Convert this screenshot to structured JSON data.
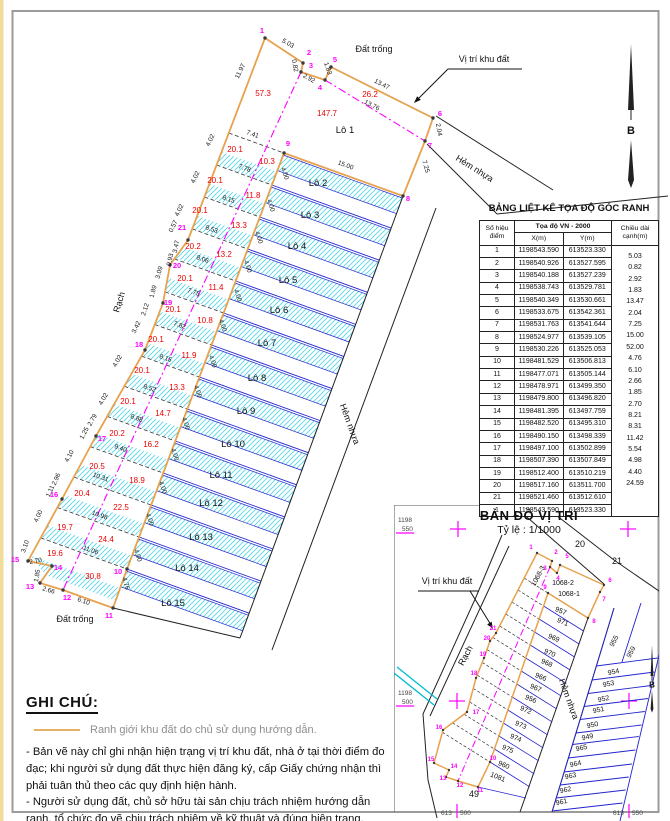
{
  "colors": {
    "orange": "#e8a14d",
    "magenta": "#ff00ff",
    "red": "#ee0000",
    "blue": "#2323cf",
    "hatch": "#56d7e9",
    "cyan": "#00bcd0",
    "black": "#1a1a1a"
  },
  "table": {
    "title": "BẢNG LIỆT KÊ TỌA ĐỘ GÓC RANH",
    "col_point_1": "Số hiệu",
    "col_point_2": "điểm",
    "col_coord": "Tọa độ VN - 2000",
    "col_x": "X(m)",
    "col_y": "Y(m)",
    "col_len_1": "Chiều dài",
    "col_len_2": "cạnh(m)",
    "rows": [
      [
        "1",
        "1198543.590",
        "613523.330"
      ],
      [
        "2",
        "1198540.926",
        "613527.595"
      ],
      [
        "3",
        "1198540.188",
        "613527.239"
      ],
      [
        "4",
        "1198538.743",
        "613529.781"
      ],
      [
        "5",
        "1198540.349",
        "613530.661"
      ],
      [
        "6",
        "1198533.675",
        "613542.361"
      ],
      [
        "7",
        "1198531.763",
        "613541.644"
      ],
      [
        "8",
        "1198524.977",
        "613539.105"
      ],
      [
        "9",
        "1198530.226",
        "613525.053"
      ],
      [
        "10",
        "1198481.529",
        "613506.813"
      ],
      [
        "11",
        "1198477.071",
        "613505.144"
      ],
      [
        "12",
        "1198478.971",
        "613499.350"
      ],
      [
        "13",
        "1198479.800",
        "613496.820"
      ],
      [
        "14",
        "1198481.395",
        "613497.759"
      ],
      [
        "15",
        "1198482.520",
        "613495.310"
      ],
      [
        "16",
        "1198490.150",
        "613498.339"
      ],
      [
        "17",
        "1198497.100",
        "613502.899"
      ],
      [
        "18",
        "1198507.390",
        "613507.849"
      ],
      [
        "19",
        "1198512.400",
        "613510.219"
      ],
      [
        "20",
        "1198517.160",
        "613511.700"
      ],
      [
        "21",
        "1198521.460",
        "613512.610"
      ],
      [
        "1",
        "1198543.590",
        "613523.330"
      ]
    ],
    "lengths": [
      "5.03",
      "0.82",
      "2.92",
      "1.83",
      "13.47",
      "2.04",
      "7.25",
      "15.00",
      "52.00",
      "4.76",
      "6.10",
      "2.66",
      "1.85",
      "2.70",
      "8.21",
      "8.31",
      "11.42",
      "5.54",
      "4.98",
      "4.40",
      "24.59"
    ]
  },
  "drawing": {
    "north_label": "B",
    "dims": [
      [
        287,
        45,
        "5.03",
        30
      ],
      [
        293,
        66,
        "0.82",
        80
      ],
      [
        308,
        80,
        "2.92",
        30
      ],
      [
        326,
        69,
        "1.83",
        72
      ],
      [
        381,
        86,
        "13.47",
        27
      ],
      [
        437,
        130,
        "2.04",
        80
      ],
      [
        424,
        167,
        "7.25",
        74
      ],
      [
        345,
        167,
        "15.00",
        20
      ],
      [
        371,
        107,
        "13.76",
        27
      ],
      [
        242,
        72,
        "11.97",
        -64
      ],
      [
        212,
        141,
        "4.02",
        -64
      ],
      [
        197,
        178,
        "4.02",
        -64
      ],
      [
        181,
        211,
        "4.02",
        -64
      ],
      [
        175,
        227,
        "0.57",
        -64
      ],
      [
        178,
        247,
        "3.47",
        -78
      ],
      [
        172,
        260,
        "0.93",
        -78
      ],
      [
        161,
        273,
        "3.09",
        -75
      ],
      [
        155,
        292,
        "1.89",
        -75
      ],
      [
        147,
        310,
        "2.12",
        -72
      ],
      [
        138,
        328,
        "3.42",
        -64
      ],
      [
        119,
        362,
        "4.02",
        -60
      ],
      [
        105,
        400,
        "4.02",
        -60
      ],
      [
        94,
        421,
        "2.79",
        -60
      ],
      [
        86,
        434,
        "1.25",
        -62
      ],
      [
        71,
        457,
        "4.10",
        -62
      ],
      [
        58,
        480,
        "2.96",
        -66
      ],
      [
        52,
        492,
        "1.11",
        -66
      ],
      [
        40,
        517,
        "4.00",
        -66
      ],
      [
        27,
        547,
        "3.10",
        -72
      ],
      [
        36,
        563,
        "2.70",
        -10
      ],
      [
        39,
        576,
        "1.85",
        -80
      ],
      [
        48,
        592,
        "2.66",
        17
      ],
      [
        83,
        603,
        "6.10",
        18
      ],
      [
        124,
        584,
        "4.76",
        74
      ],
      [
        252,
        136,
        "7.41",
        20
      ],
      [
        244,
        170,
        "7.78",
        20
      ],
      [
        228,
        201,
        "8.15",
        20
      ],
      [
        211,
        231,
        "8.53",
        20
      ],
      [
        202,
        261,
        "8.06",
        20
      ],
      [
        193,
        294,
        "7.75",
        20
      ],
      [
        179,
        327,
        "7.82",
        20
      ],
      [
        165,
        360,
        "8.15",
        20
      ],
      [
        149,
        390,
        "8.52",
        20
      ],
      [
        136,
        420,
        "8.88",
        20
      ],
      [
        120,
        450,
        "9.40",
        20
      ],
      [
        100,
        479,
        "10.31",
        20
      ],
      [
        99,
        517,
        "10.98",
        20
      ],
      [
        90,
        552,
        "11.06",
        20
      ],
      [
        283,
        174,
        "4.00",
        72
      ],
      [
        269,
        206,
        "4.00",
        72
      ],
      [
        257,
        238,
        "4.00",
        72
      ],
      [
        246,
        267,
        "4.00",
        72
      ],
      [
        236,
        296,
        "4.00",
        72
      ],
      [
        221,
        326,
        "4.00",
        72
      ],
      [
        211,
        362,
        "4.00",
        72
      ],
      [
        196,
        392,
        "4.00",
        72
      ],
      [
        184,
        424,
        "4.00",
        72
      ],
      [
        173,
        455,
        "4.00",
        72
      ],
      [
        161,
        488,
        "4.00",
        72
      ],
      [
        148,
        520,
        "4.00",
        72
      ],
      [
        136,
        556,
        "4.00",
        72
      ]
    ],
    "areas": [
      [
        263,
        96,
        "57.3"
      ],
      [
        327,
        116,
        "147.7"
      ],
      [
        370,
        97,
        "26.2"
      ],
      [
        235,
        152,
        "20.1"
      ],
      [
        215,
        183,
        "20.1"
      ],
      [
        200,
        213,
        "20.1"
      ],
      [
        193,
        249,
        "20.2"
      ],
      [
        185,
        281,
        "20.1"
      ],
      [
        173,
        312,
        "20.1"
      ],
      [
        156,
        342,
        "20.1"
      ],
      [
        142,
        373,
        "20.1"
      ],
      [
        128,
        404,
        "20.1"
      ],
      [
        117,
        436,
        "20.2"
      ],
      [
        97,
        469,
        "20.5"
      ],
      [
        82,
        496,
        "20.4"
      ],
      [
        65,
        530,
        "19.7"
      ],
      [
        55,
        556,
        "19.6"
      ],
      [
        267,
        164,
        "10.3"
      ],
      [
        253,
        198,
        "11.8"
      ],
      [
        239,
        228,
        "13.3"
      ],
      [
        224,
        257,
        "13.2"
      ],
      [
        216,
        290,
        "11.4"
      ],
      [
        205,
        323,
        "10.8"
      ],
      [
        189,
        358,
        "11.9"
      ],
      [
        177,
        390,
        "13.3"
      ],
      [
        163,
        416,
        "14.7"
      ],
      [
        151,
        447,
        "16.2"
      ],
      [
        137,
        483,
        "18.9"
      ],
      [
        121,
        510,
        "22.5"
      ],
      [
        106,
        542,
        "24.4"
      ],
      [
        93,
        579,
        "30.8"
      ]
    ],
    "points": [
      [
        262,
        33,
        "1"
      ],
      [
        309,
        55,
        "2"
      ],
      [
        311,
        68,
        "3"
      ],
      [
        320,
        90,
        "4"
      ],
      [
        335,
        62,
        "5"
      ],
      [
        440,
        116,
        "6"
      ],
      [
        430,
        148,
        "7"
      ],
      [
        408,
        201,
        "8"
      ],
      [
        288,
        146,
        "9"
      ],
      [
        118,
        574,
        "10"
      ],
      [
        109,
        618,
        "11"
      ],
      [
        67,
        600,
        "12"
      ],
      [
        30,
        589,
        "13"
      ],
      [
        58,
        570,
        "14"
      ],
      [
        15,
        562,
        "15"
      ],
      [
        54,
        497,
        "16"
      ],
      [
        102,
        441,
        "17"
      ],
      [
        139,
        347,
        "18"
      ],
      [
        168,
        305,
        "19"
      ],
      [
        177,
        268,
        "20"
      ],
      [
        182,
        230,
        "21"
      ]
    ],
    "lots": [
      [
        345,
        133,
        "Lô 1"
      ],
      [
        318,
        186,
        "Lô 2"
      ],
      [
        310,
        218,
        "Lô 3"
      ],
      [
        297,
        249,
        "Lô 4"
      ],
      [
        288,
        283,
        "Lô 5"
      ],
      [
        279,
        313,
        "Lô 6"
      ],
      [
        267,
        346,
        "Lô 7"
      ],
      [
        257,
        381,
        "Lô 8"
      ],
      [
        246,
        414,
        "Lô 9"
      ],
      [
        233,
        447,
        "Lô 10"
      ],
      [
        221,
        478,
        "Lô 11"
      ],
      [
        211,
        506,
        "Lô 12"
      ],
      [
        201,
        540,
        "Lô 13"
      ],
      [
        187,
        571,
        "Lô 14"
      ],
      [
        173,
        606,
        "Lô 15"
      ]
    ],
    "notes": [
      [
        374,
        52,
        "Đất trống",
        0
      ],
      [
        75,
        622,
        "Đất trống",
        0
      ],
      [
        473,
        171,
        "Hẻm nhựa",
        32
      ],
      [
        347,
        425,
        "Hẻm nhựa",
        70
      ],
      [
        122,
        303,
        "Rạch",
        -73
      ],
      [
        484,
        62,
        "Vị trí khu đất",
        0
      ]
    ]
  },
  "map": {
    "title": "BẢN ĐỒ VỊ TRÍ",
    "scale": "Tỷ lệ : 1/1000",
    "north_label": "B",
    "grid": [
      [
        398,
        522,
        "1198"
      ],
      [
        402,
        531,
        "550"
      ],
      [
        398,
        695,
        "1198"
      ],
      [
        402,
        704,
        "500"
      ],
      [
        441,
        815,
        "613"
      ],
      [
        460,
        815,
        "500"
      ],
      [
        613,
        815,
        "613"
      ],
      [
        632,
        815,
        "550"
      ]
    ],
    "points": [
      [
        531,
        549,
        "1"
      ],
      [
        556,
        554,
        "2"
      ],
      [
        545,
        570,
        "3"
      ],
      [
        558,
        580,
        "4"
      ],
      [
        567,
        558,
        "5"
      ],
      [
        610,
        582,
        "6"
      ],
      [
        604,
        601,
        "7"
      ],
      [
        594,
        623,
        "8"
      ],
      [
        545,
        589,
        "9"
      ],
      [
        493,
        760,
        "10"
      ],
      [
        480,
        792,
        "11"
      ],
      [
        460,
        787,
        "12"
      ],
      [
        443,
        780,
        "13"
      ],
      [
        454,
        768,
        "14"
      ],
      [
        431,
        761,
        "15"
      ],
      [
        439,
        729,
        "16"
      ],
      [
        476,
        714,
        "17"
      ],
      [
        474,
        675,
        "18"
      ],
      [
        483,
        656,
        "19"
      ],
      [
        487,
        640,
        "20"
      ],
      [
        493,
        630,
        "21"
      ]
    ],
    "parcels": [
      [
        560,
        613,
        "957",
        22
      ],
      [
        562,
        624,
        "971",
        22
      ],
      [
        553,
        640,
        "969",
        22
      ],
      [
        549,
        655,
        "970",
        22
      ],
      [
        546,
        665,
        "968",
        22
      ],
      [
        540,
        679,
        "966",
        22
      ],
      [
        535,
        690,
        "967",
        22
      ],
      [
        530,
        701,
        "956",
        22
      ],
      [
        525,
        712,
        "972",
        22
      ],
      [
        520,
        727,
        "973",
        22
      ],
      [
        515,
        740,
        "974",
        22
      ],
      [
        507,
        751,
        "975",
        22
      ],
      [
        503,
        767,
        "960",
        22
      ],
      [
        497,
        779,
        "1081",
        22
      ],
      [
        614,
        674,
        "954",
        -12
      ],
      [
        609,
        686,
        "953",
        -12
      ],
      [
        604,
        701,
        "952",
        -12
      ],
      [
        599,
        712,
        "951",
        -12
      ],
      [
        593,
        727,
        "950",
        -12
      ],
      [
        588,
        739,
        "949",
        -12
      ],
      [
        582,
        750,
        "965",
        -12
      ],
      [
        576,
        766,
        "964",
        -12
      ],
      [
        571,
        778,
        "963",
        -12
      ],
      [
        566,
        792,
        "962",
        -12
      ],
      [
        562,
        804,
        "961",
        -12
      ],
      [
        616,
        642,
        "955",
        -62
      ],
      [
        633,
        653,
        "959",
        -62
      ],
      [
        540,
        577,
        "1068-3",
        -62
      ],
      [
        563,
        585,
        "1068-2",
        0
      ],
      [
        569,
        596,
        "1068-1",
        0
      ]
    ],
    "bigs": [
      [
        580,
        547,
        "20"
      ],
      [
        617,
        564,
        "21"
      ],
      [
        474,
        797,
        "49"
      ]
    ],
    "notes": [
      [
        447,
        584,
        "Vị trí khu đất",
        0
      ],
      [
        566,
        700,
        "Hẻm nhựa",
        70
      ],
      [
        468,
        657,
        "Rạch",
        -62
      ]
    ]
  },
  "legend": {
    "heading": "GHI CHÚ:",
    "swatch_text": "Ranh giới khu đất do chủ sử dụng hướng dẫn.",
    "para1": "- Bản vẽ này chỉ ghi nhận hiện trạng vị trí khu đất, nhà ở tại thời điểm đo đạc; khi người sử dụng đất thực hiện đăng ký, cấp Giấy chứng nhận thì phải tuân thủ theo các quy định hiện hành.",
    "para2": "- Người sử dụng đất, chủ sở hữu tài sản chịu trách nhiệm hướng dẫn ranh, tổ chức đo vẽ chịu trách nhiệm về kỹ thuật và đúng hiện trạng."
  }
}
